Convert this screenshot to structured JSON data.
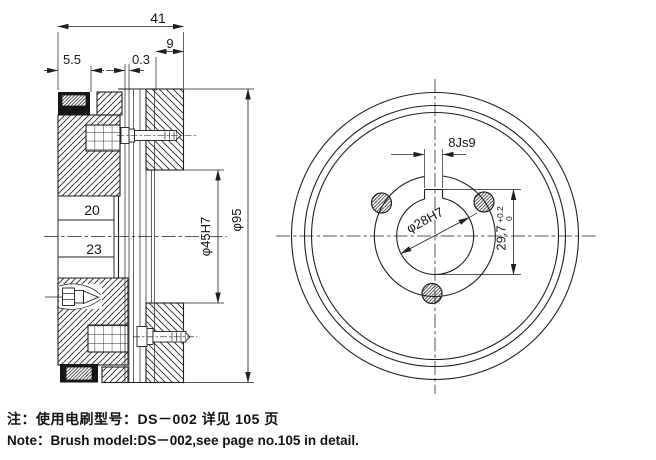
{
  "page": {
    "background": "#ffffff",
    "ink": "#1f1f1f",
    "description": "engineering drawing of electromagnetic clutch, section and front views"
  },
  "section_view": {
    "dims": {
      "total_width": "41",
      "cap_width": "5.5",
      "air_gap": "0.3",
      "hub_depth": "9",
      "sleeve_upper": "20",
      "sleeve_lower": "23",
      "bore_dia": "φ45H7",
      "outer_dia": "φ95"
    }
  },
  "front_view": {
    "dims": {
      "key_width": "8Js9",
      "bore_dia": "φ28H7",
      "keyway_height": "29.7",
      "keyway_tol_upper": "+0.2",
      "keyway_tol_lower": "0"
    }
  },
  "notes": {
    "cn": "注：使用电刷型号：DS－002 详见 105 页",
    "en": "Note：Brush model:DS－002,see page no.105 in detail."
  }
}
